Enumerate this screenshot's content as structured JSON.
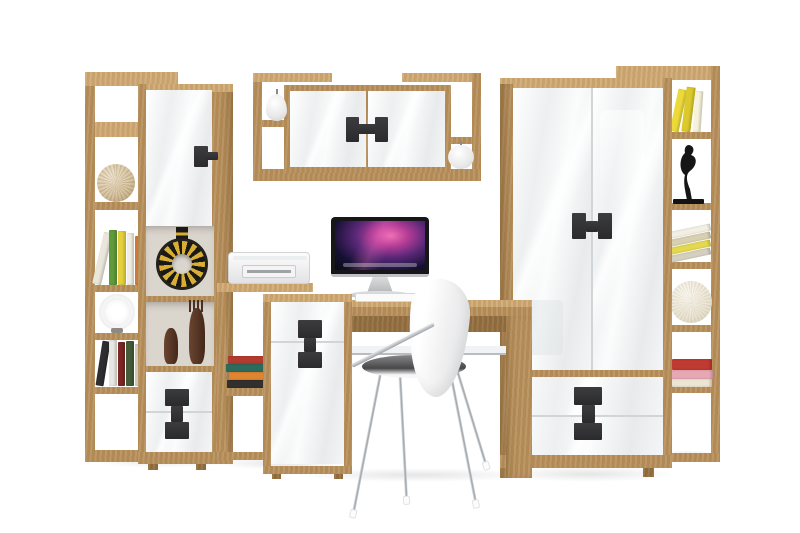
{
  "meta": {
    "title": "Home office wall unit furniture set — product photo on white background"
  },
  "palette": {
    "background": "#ffffff",
    "wood": "#b78f5b",
    "woodLight": "#cfa973",
    "woodDark": "#926d3e",
    "front": "#f3f4f6",
    "handle": "#2b2b2d",
    "chrome": "#b8bdc2",
    "interior": "#dad5cd",
    "shadow": "rgba(0,0,0,0.10)"
  },
  "units": {
    "left_bookcase": {
      "name": "Tall open shelf unit with decor"
    },
    "left_cabinet": {
      "name": "Tall cabinet with door, open niches and drawers"
    },
    "wall_shelf": {
      "name": "Wall-mounted shelf with two-door cabinet"
    },
    "printer_stand": {
      "name": "Stepped open shelf with printer"
    },
    "desk": {
      "name": "Oak desk"
    },
    "desk_cabinet": {
      "name": "Desk cabinet with white front"
    },
    "wardrobe": {
      "name": "Two-door wardrobe with two drawers"
    },
    "right_bookcase": {
      "name": "Tall open shelf unit with books and decor"
    },
    "chair": {
      "name": "White chair with chrome legs"
    }
  },
  "decor": {
    "twine_ball": "Twine ball ornament",
    "books": "Books",
    "spiral_shell": "Spiral shell ornament",
    "tribal_vase": "Tribal ring vase",
    "figurines": "Wooden figurines",
    "pear": "White pear ornament",
    "apple": "White apple ornament",
    "sculpture": "Black figurine sculpture",
    "sphere": "Rattan sphere ornament",
    "printer": "White printer",
    "computer": "iMac computer with purple nebula wallpaper",
    "keyboard": "Keyboard",
    "mouse": "Mouse"
  }
}
